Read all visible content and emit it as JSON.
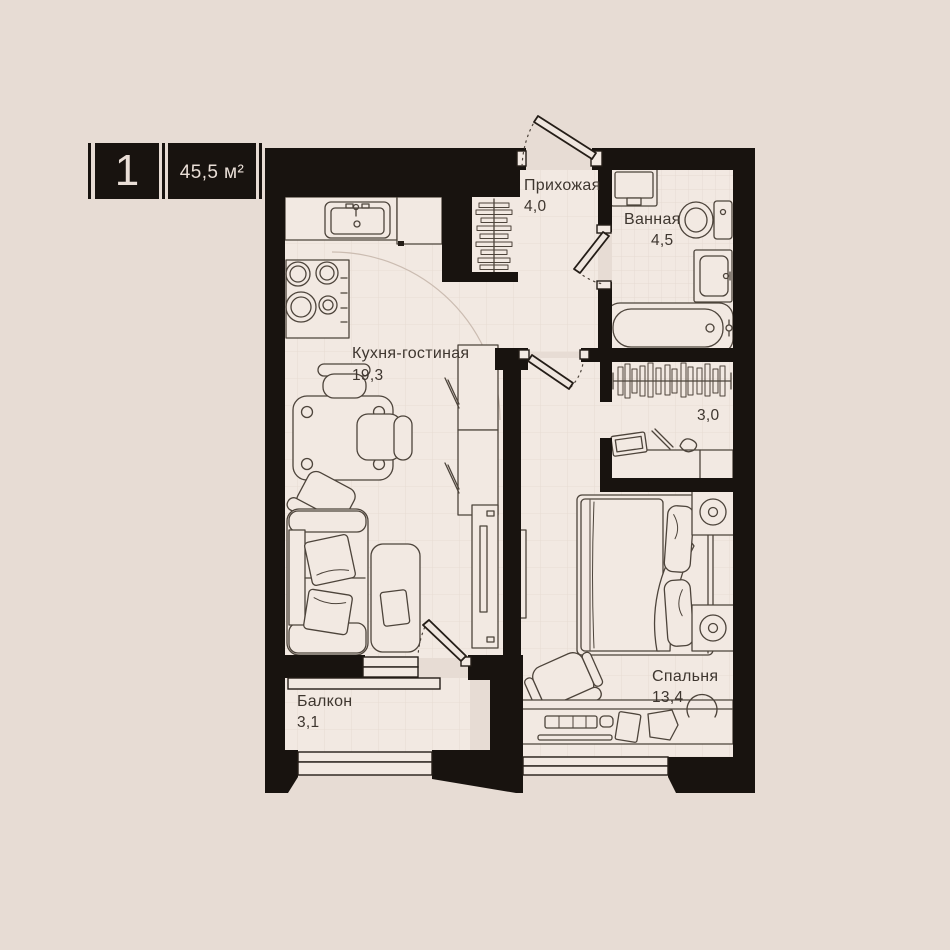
{
  "badge": {
    "unit_number": "1",
    "unit_area": "45,5 м²"
  },
  "rooms": {
    "hallway": {
      "name": "Прихожая",
      "area": "4,0"
    },
    "bathroom": {
      "name": "Ванная",
      "area": "4,5"
    },
    "kitchen_living": {
      "name": "Кухня-гостиная",
      "area": "19,3"
    },
    "wardrobe": {
      "area": "3,0"
    },
    "bedroom": {
      "name": "Спальня",
      "area": "13,4"
    },
    "balcony": {
      "name": "Балкон",
      "area": "3,1"
    }
  },
  "furniture_depicted": [
    "kitchen-sink",
    "stove",
    "dining-table",
    "chairs",
    "sofa",
    "coffee-table",
    "tv-unit",
    "coat-hangers",
    "washing-machine",
    "toilet",
    "bathroom-sink",
    "bathtub",
    "wardrobe-rail",
    "vanity-table",
    "double-bed",
    "nightstands",
    "desk",
    "office-chair",
    "wall-tv"
  ],
  "colors": {
    "background": "#e7dcd4",
    "floor": "#f2e9e2",
    "walls": "#18130f",
    "furniture_lines": "#4d443b",
    "text": "#3e362f",
    "badge_background": "#18130f",
    "badge_text": "#e9ded6"
  }
}
